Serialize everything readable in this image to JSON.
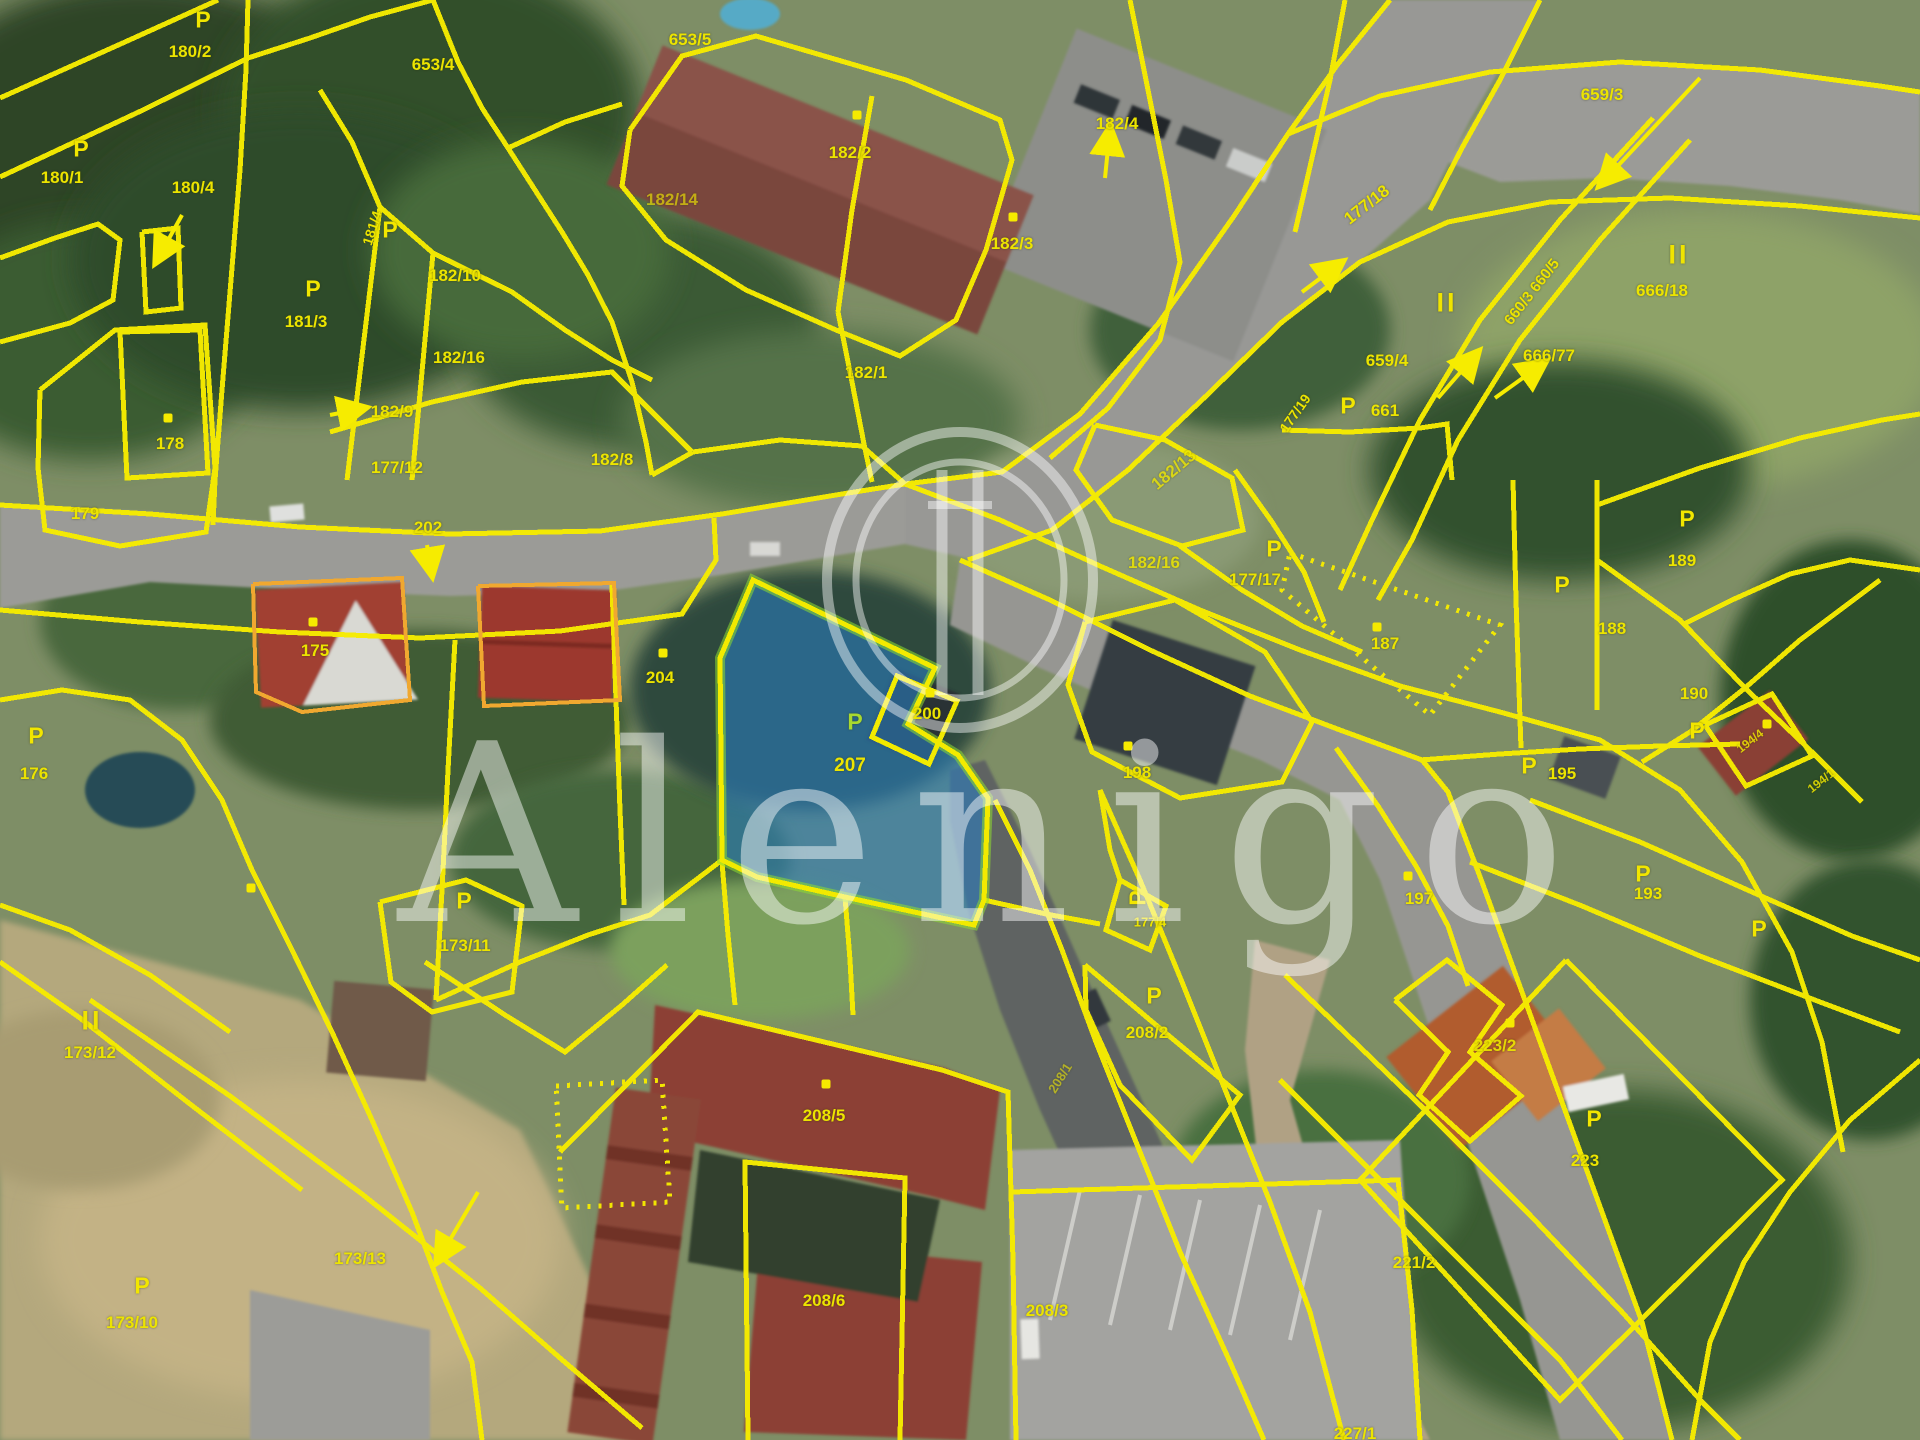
{
  "watermark": {
    "text": "Alenigo"
  },
  "colors": {
    "boundary_yellow": "#f6ec00",
    "label_yellow": "#ece400",
    "building_outline_orange": "#f0a830",
    "highlight_parcel_fill": "#297ec1",
    "highlight_parcel_edge": "#8edc30",
    "watermark_white": "#ffffff"
  },
  "highlighted_parcel": {
    "number": "207"
  },
  "map": {
    "labels": [
      {
        "t": "180/2",
        "x": 190,
        "y": 52
      },
      {
        "t": "653/4",
        "x": 433,
        "y": 65
      },
      {
        "t": "653/5",
        "x": 690,
        "y": 40
      },
      {
        "t": "180/1",
        "x": 62,
        "y": 178
      },
      {
        "t": "180/4",
        "x": 193,
        "y": 188
      },
      {
        "t": "181/3",
        "x": 306,
        "y": 322
      },
      {
        "t": "181/4",
        "x": 372,
        "y": 228,
        "r": -72,
        "s": 14
      },
      {
        "t": "182/10",
        "x": 455,
        "y": 276
      },
      {
        "t": "182/16",
        "x": 459,
        "y": 358
      },
      {
        "t": "182/9",
        "x": 392,
        "y": 412
      },
      {
        "t": "177/12",
        "x": 397,
        "y": 468
      },
      {
        "t": "182/8",
        "x": 612,
        "y": 460
      },
      {
        "t": "178",
        "x": 170,
        "y": 444
      },
      {
        "t": "179",
        "x": 85,
        "y": 514
      },
      {
        "t": "202",
        "x": 428,
        "y": 528
      },
      {
        "t": "182/14",
        "x": 672,
        "y": 200,
        "o": 0.65
      },
      {
        "t": "182/2",
        "x": 850,
        "y": 153
      },
      {
        "t": "182/4",
        "x": 1117,
        "y": 124
      },
      {
        "t": "182/3",
        "x": 1012,
        "y": 244
      },
      {
        "t": "182/1",
        "x": 866,
        "y": 373
      },
      {
        "t": "182/13",
        "x": 1174,
        "y": 470,
        "r": -40,
        "o": 0.8
      },
      {
        "t": "182/16",
        "x": 1154,
        "y": 563,
        "o": 0.85
      },
      {
        "t": "177/17",
        "x": 1255,
        "y": 580
      },
      {
        "t": "659/3",
        "x": 1602,
        "y": 95
      },
      {
        "t": "177/18",
        "x": 1367,
        "y": 205,
        "r": -38
      },
      {
        "t": "660/3 660/5",
        "x": 1532,
        "y": 292,
        "r": -52,
        "s": 15
      },
      {
        "t": "666/18",
        "x": 1662,
        "y": 291
      },
      {
        "t": "666/77",
        "x": 1549,
        "y": 356
      },
      {
        "t": "659/4",
        "x": 1387,
        "y": 361
      },
      {
        "t": "661",
        "x": 1385,
        "y": 411
      },
      {
        "t": "177/19",
        "x": 1295,
        "y": 413,
        "r": -55,
        "s": 14
      },
      {
        "t": "175",
        "x": 315,
        "y": 651
      },
      {
        "t": "176",
        "x": 34,
        "y": 774
      },
      {
        "t": "204",
        "x": 660,
        "y": 678
      },
      {
        "t": "200",
        "x": 927,
        "y": 714
      },
      {
        "t": "207",
        "x": 850,
        "y": 766,
        "s": 19
      },
      {
        "t": "198",
        "x": 1137,
        "y": 773
      },
      {
        "t": "187",
        "x": 1385,
        "y": 644
      },
      {
        "t": "188",
        "x": 1612,
        "y": 629
      },
      {
        "t": "189",
        "x": 1682,
        "y": 561
      },
      {
        "t": "190",
        "x": 1694,
        "y": 694
      },
      {
        "t": "195",
        "x": 1562,
        "y": 774
      },
      {
        "t": "194/4",
        "x": 1750,
        "y": 741,
        "r": -38,
        "s": 12,
        "o": 0.85
      },
      {
        "t": "194/1",
        "x": 1821,
        "y": 781,
        "r": -38,
        "s": 12,
        "o": 0.85
      },
      {
        "t": "193",
        "x": 1648,
        "y": 894
      },
      {
        "t": "197",
        "x": 1419,
        "y": 899
      },
      {
        "t": "177/4",
        "x": 1150,
        "y": 922,
        "s": 13
      },
      {
        "t": "173/11",
        "x": 465,
        "y": 946
      },
      {
        "t": "173/12",
        "x": 90,
        "y": 1053
      },
      {
        "t": "173/13",
        "x": 360,
        "y": 1259
      },
      {
        "t": "173/10",
        "x": 132,
        "y": 1323
      },
      {
        "t": "208/2",
        "x": 1147,
        "y": 1033
      },
      {
        "t": "208/5",
        "x": 824,
        "y": 1116
      },
      {
        "t": "208/6",
        "x": 824,
        "y": 1301
      },
      {
        "t": "208/3",
        "x": 1047,
        "y": 1311
      },
      {
        "t": "208/1",
        "x": 1060,
        "y": 1078,
        "r": -58,
        "s": 13,
        "o": 0.6
      },
      {
        "t": "223/2",
        "x": 1495,
        "y": 1046,
        "o": 0.9
      },
      {
        "t": "223",
        "x": 1585,
        "y": 1161
      },
      {
        "t": "221/2",
        "x": 1414,
        "y": 1263
      },
      {
        "t": "227/1",
        "x": 1355,
        "y": 1434
      }
    ],
    "p_symbols": [
      {
        "x": 203,
        "y": 20
      },
      {
        "x": 81,
        "y": 149
      },
      {
        "x": 313,
        "y": 289
      },
      {
        "x": 390,
        "y": 230
      },
      {
        "x": 1274,
        "y": 549
      },
      {
        "x": 36,
        "y": 736
      },
      {
        "x": 464,
        "y": 901
      },
      {
        "x": 1138,
        "y": 898,
        "r": -90
      },
      {
        "x": 1562,
        "y": 585
      },
      {
        "x": 1687,
        "y": 519
      },
      {
        "x": 1697,
        "y": 731
      },
      {
        "x": 1529,
        "y": 766
      },
      {
        "x": 1643,
        "y": 874
      },
      {
        "x": 1759,
        "y": 929
      },
      {
        "x": 1154,
        "y": 996
      },
      {
        "x": 1594,
        "y": 1119
      },
      {
        "x": 142,
        "y": 1286
      },
      {
        "x": 1348,
        "y": 406
      },
      {
        "x": 855,
        "y": 722,
        "g": 1
      }
    ],
    "roman_marks": [
      {
        "x": 1447,
        "y": 303
      },
      {
        "x": 1679,
        "y": 255
      },
      {
        "x": 92,
        "y": 1021
      }
    ],
    "dots": [
      {
        "x": 857,
        "y": 115
      },
      {
        "x": 1013,
        "y": 217
      },
      {
        "x": 168,
        "y": 418
      },
      {
        "x": 313,
        "y": 622
      },
      {
        "x": 663,
        "y": 653
      },
      {
        "x": 930,
        "y": 693
      },
      {
        "x": 1128,
        "y": 746
      },
      {
        "x": 1377,
        "y": 627
      },
      {
        "x": 1408,
        "y": 876
      },
      {
        "x": 826,
        "y": 1084
      },
      {
        "x": 1510,
        "y": 1023
      },
      {
        "x": 1767,
        "y": 724
      },
      {
        "x": 251,
        "y": 888
      }
    ],
    "arrows": [
      {
        "x1": 1105,
        "y1": 178,
        "x2": 1110,
        "y2": 128
      },
      {
        "x1": 1495,
        "y1": 398,
        "x2": 1545,
        "y2": 362
      },
      {
        "x1": 1438,
        "y1": 398,
        "x2": 1478,
        "y2": 352
      },
      {
        "x1": 1700,
        "y1": 78,
        "x2": 1600,
        "y2": 185
      },
      {
        "x1": 330,
        "y1": 415,
        "x2": 365,
        "y2": 408
      },
      {
        "x1": 427,
        "y1": 545,
        "x2": 432,
        "y2": 575
      },
      {
        "x1": 478,
        "y1": 1192,
        "x2": 437,
        "y2": 1262
      },
      {
        "x1": 182,
        "y1": 215,
        "x2": 156,
        "y2": 262
      },
      {
        "x1": 1302,
        "y1": 292,
        "x2": 1342,
        "y2": 262
      }
    ]
  }
}
